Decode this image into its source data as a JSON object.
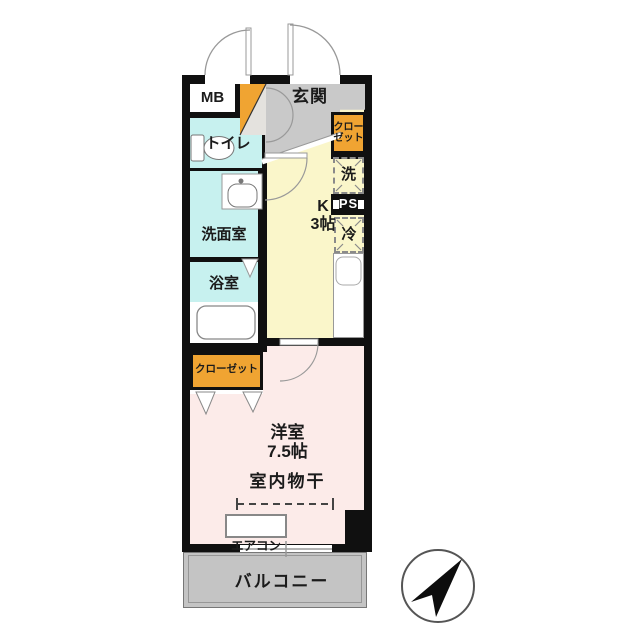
{
  "plan": {
    "labels": {
      "mb": "MB",
      "entrance": "玄関",
      "closet_top": {
        "line1": "クロー",
        "line2": "ゼット"
      },
      "toilet": "トイレ",
      "washroom": "洗面室",
      "bathroom": "浴室",
      "washer": "洗",
      "ps": "PS",
      "fridge": "冷",
      "kitchen": {
        "line1": "K",
        "line2": "3帖"
      },
      "closet_bottom": "クローゼット",
      "bedroom": {
        "line1": "洋室",
        "line2": "7.5帖"
      },
      "indoor_drying": "室内物干",
      "aircon": "エアコン",
      "balcony": "バルコニー"
    },
    "compass": {
      "direction": "north-east"
    },
    "colors": {
      "wall": "#101010",
      "closet_orange": "#F0A432",
      "kitchen_yellow": "#FAF6CA",
      "sanitary_cyan": "#C7F1EF",
      "bedroom_pink": "#FCEBE9",
      "entry_gray": "#C9C9C9",
      "balcony_gray": "#C4C4C4"
    }
  }
}
